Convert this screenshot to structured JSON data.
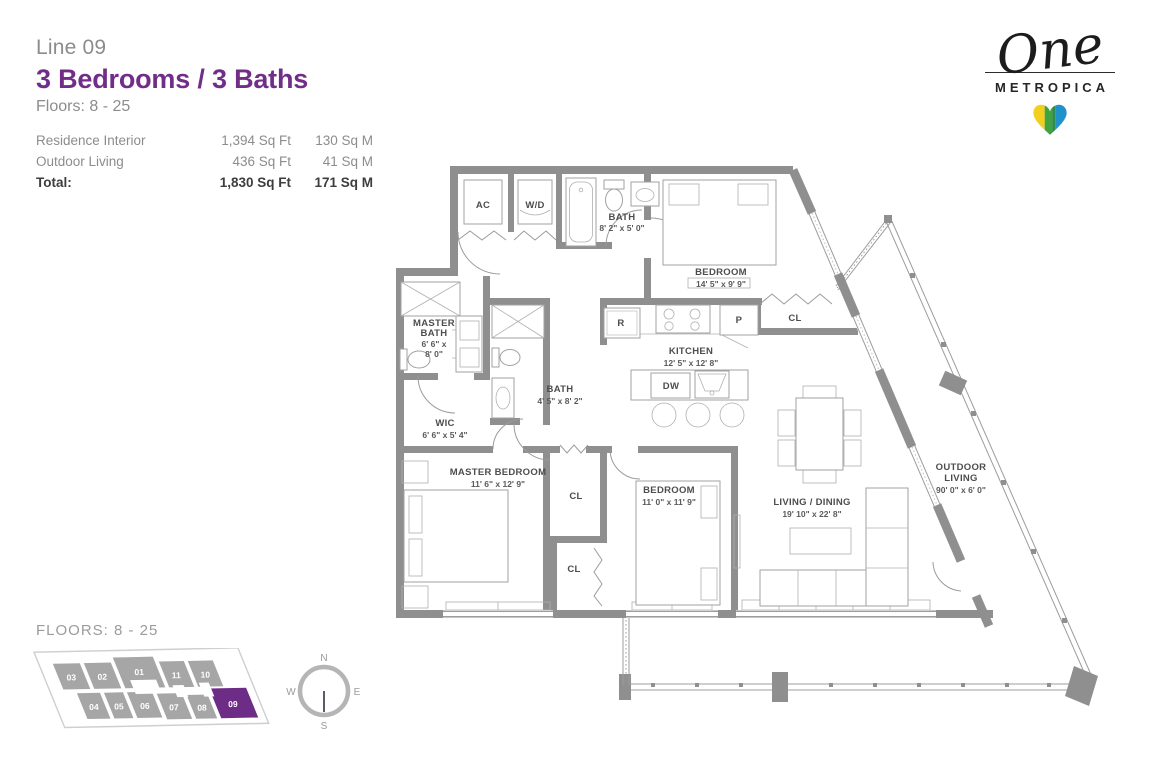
{
  "header": {
    "line_label": "Line 09",
    "title": "3 Bedrooms / 3 Baths",
    "floors": "Floors: 8 - 25",
    "area_rows": [
      {
        "label": "Residence Interior",
        "sqft": "1,394 Sq Ft",
        "sqm": "130 Sq M"
      },
      {
        "label": "Outdoor Living",
        "sqft": "436 Sq Ft",
        "sqm": "41 Sq M"
      },
      {
        "label": "Total:",
        "sqft": "1,830 Sq Ft",
        "sqm": "171 Sq M"
      }
    ]
  },
  "logo": {
    "script": "One",
    "name": "METROPICA"
  },
  "plan": {
    "labels": {
      "ac": "AC",
      "wd": "W/D",
      "bath1_name": "BATH",
      "bath1_dims": "8' 2\" x 5' 0\"",
      "bedroom1_name": "BEDROOM",
      "bedroom1_dims": "14' 5\" x 9' 9\"",
      "cl1": "CL",
      "fridge": "R",
      "pantry": "P",
      "kitchen_name": "KITCHEN",
      "kitchen_dims": "12' 5\" x 12' 8\"",
      "dishwasher": "DW",
      "master_bath_l1": "MASTER",
      "master_bath_l2": "BATH",
      "master_bath_d1": "6' 6\" x",
      "master_bath_d2": "8' 0\"",
      "bath2_name": "BATH",
      "bath2_dims": "4' 5\" x 8' 2\"",
      "wic_name": "WIC",
      "wic_dims": "6' 6\" x 5' 4\"",
      "master_bedroom_name": "MASTER BEDROOM",
      "master_bedroom_dims": "11' 6\" x 12' 9\"",
      "cl2": "CL",
      "cl3": "CL",
      "bedroom2_name": "BEDROOM",
      "bedroom2_dims": "11' 0\" x 11' 9\"",
      "living_name": "LIVING / DINING",
      "living_dims": "19' 10\" x 22' 8\"",
      "outdoor_l1": "OUTDOOR",
      "outdoor_l2": "LIVING",
      "outdoor_dims": "90' 0\" x 6' 0\""
    }
  },
  "footer": {
    "floors_label": "FLOORS: 8 - 25",
    "key_plan": {
      "active": "09",
      "units": [
        "01",
        "02",
        "03",
        "04",
        "05",
        "06",
        "07",
        "08",
        "09",
        "10",
        "11"
      ]
    },
    "compass": {
      "n": "N",
      "e": "E",
      "s": "S",
      "w": "W"
    }
  },
  "colors": {
    "accent_purple": "#712d87",
    "unit_active_purple": "#6d2c85",
    "unit_gray": "#a6a6a6",
    "wall_gray": "#8f8f8f",
    "text_gray": "#8c8c8c",
    "heart_yellow": "#f2cf1d",
    "heart_green": "#3fa33f",
    "heart_blue": "#2191cc",
    "compass_needle": "#3a2f45"
  }
}
